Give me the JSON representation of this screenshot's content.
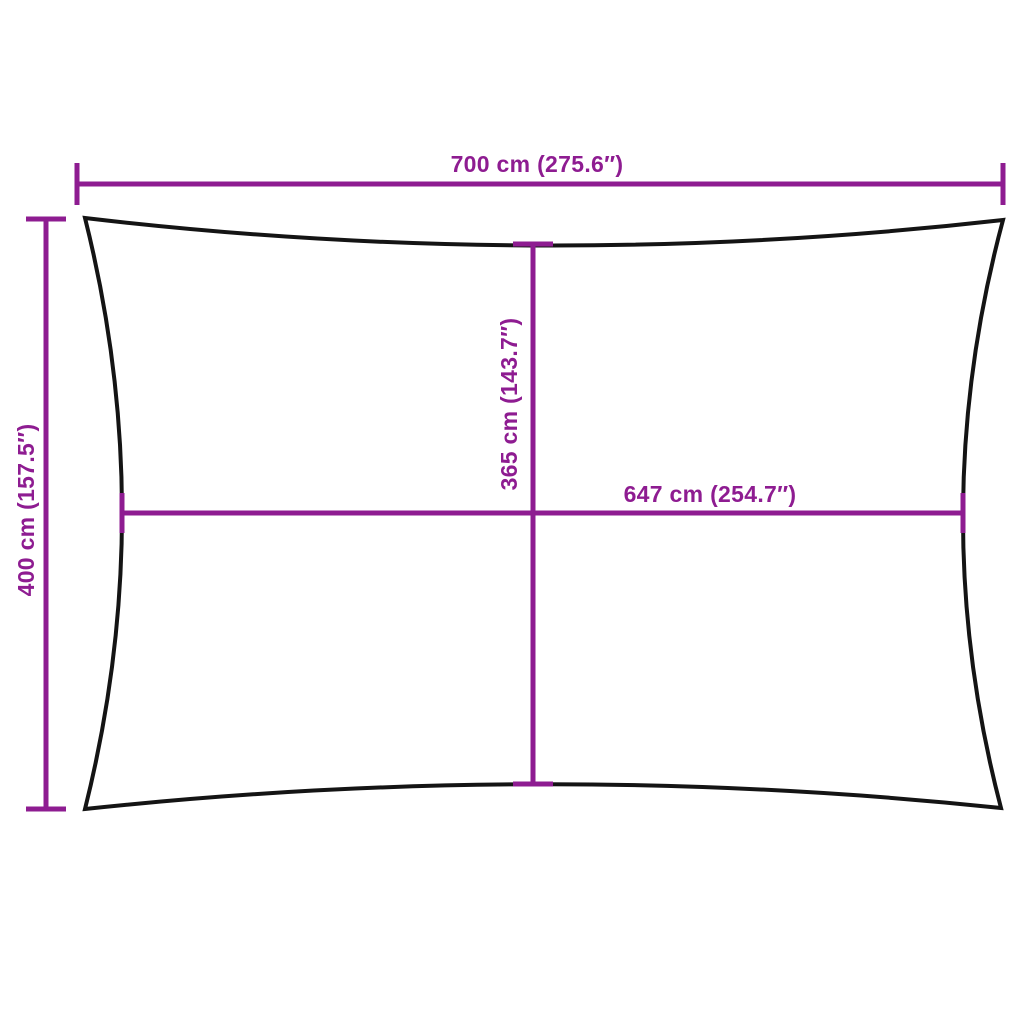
{
  "colors": {
    "dimension": "#8e1c91",
    "outline": "#141414",
    "background": "#ffffff"
  },
  "diagram": {
    "subject": "rectangular-shade-sail-dimension-diagram",
    "labels": {
      "width_top": "700 cm (275.6″)",
      "height_left": "400 cm (157.5″)",
      "height_center": "365 cm (143.7″)",
      "width_center": "647 cm (254.7″)"
    }
  }
}
